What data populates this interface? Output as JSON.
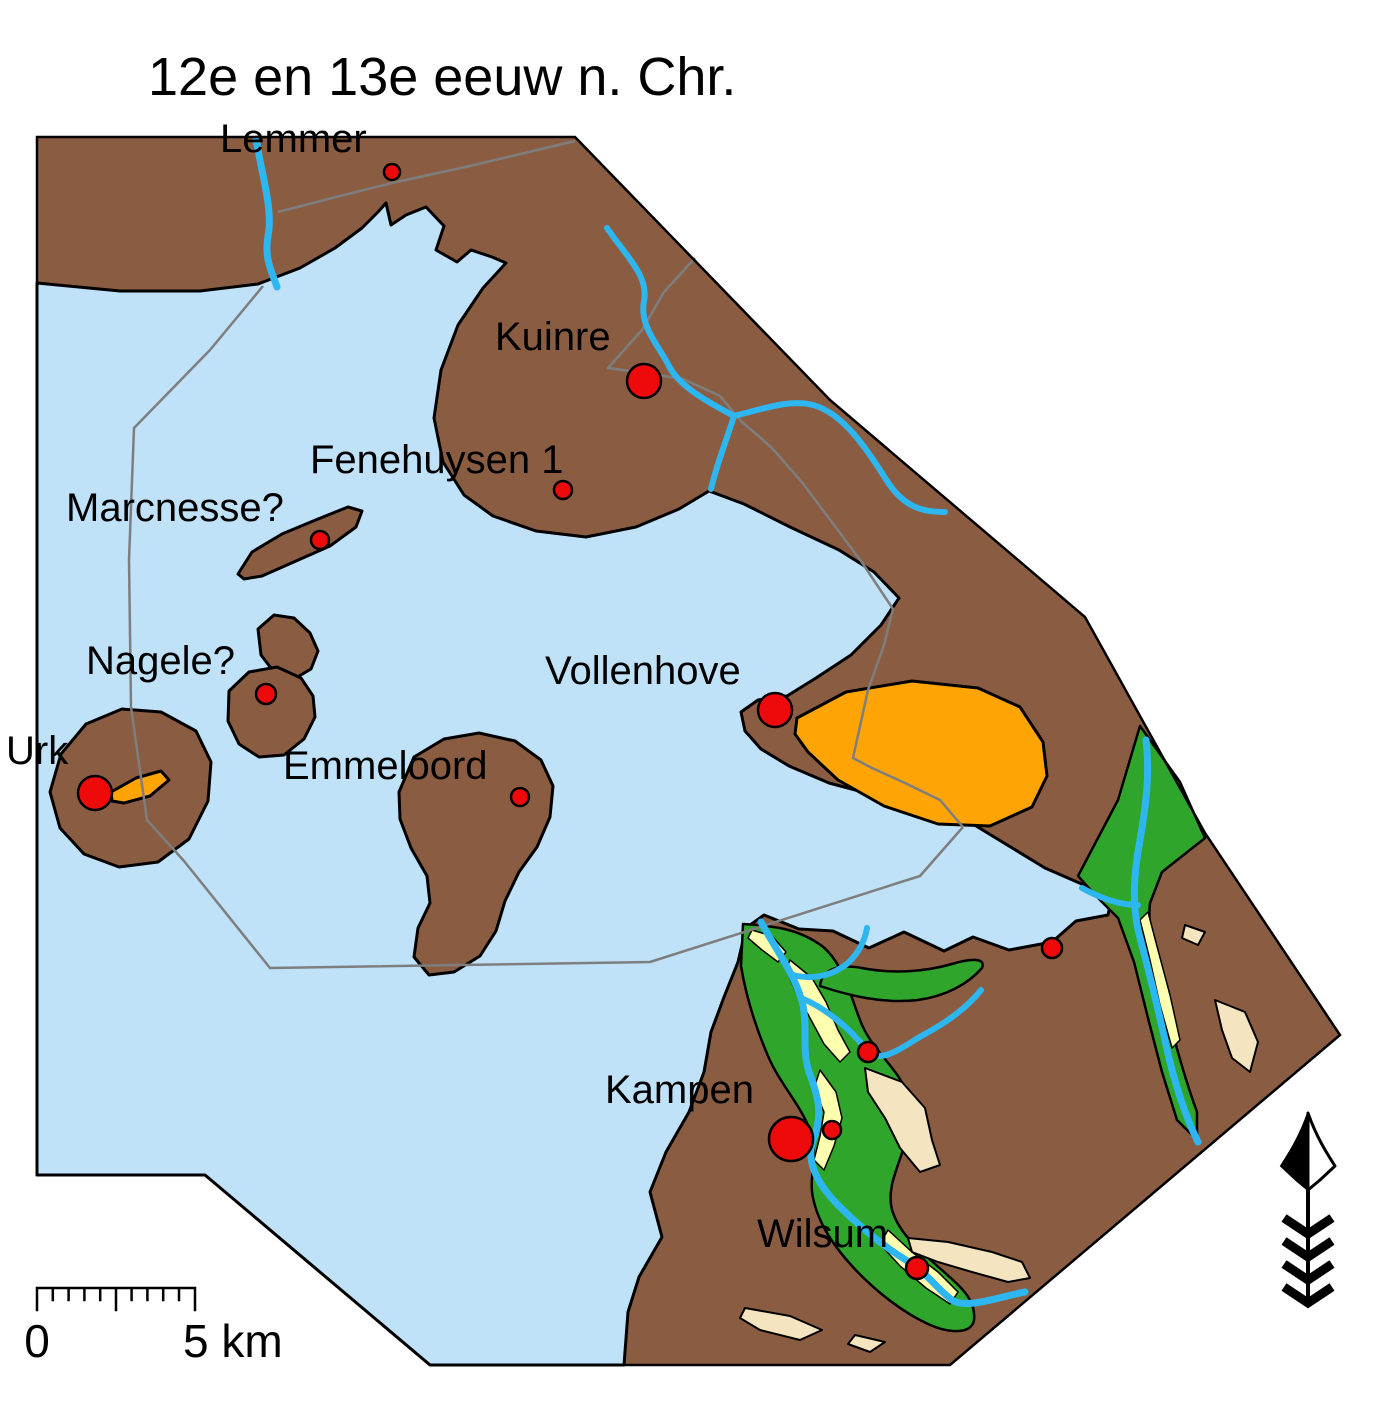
{
  "title": "12e en 13e eeuw n. Chr.",
  "colors": {
    "water": "#BFE2F8",
    "land": "#8A5C42",
    "sand_high": "#FFA405",
    "floodplain": "#2FA52B",
    "levee": "#FFFFB0",
    "river_dune": "#F4E4C0",
    "river": "#2EB6F0",
    "settlement_dot": "#EE0A0A",
    "boundary_gray": "#7E7E7E",
    "outline": "#000000",
    "background": "#FFFFFF"
  },
  "scale_bar": {
    "label_start": "0",
    "label_end": "5 km"
  },
  "north_arrow": "north-arrow",
  "settlements": [
    {
      "id": "lemmer",
      "name": "Lemmer",
      "dot": {
        "x": 392,
        "y": 172,
        "r": 8
      },
      "label": {
        "x": 220,
        "y": 152
      }
    },
    {
      "id": "kuinre",
      "name": "Kuinre",
      "dot": {
        "x": 644,
        "y": 381,
        "r": 17
      },
      "label": {
        "x": 495,
        "y": 350
      }
    },
    {
      "id": "fenehuysen-1",
      "name": "Fenehuysen 1",
      "dot": {
        "x": 563,
        "y": 490,
        "r": 9
      },
      "label": {
        "x": 310,
        "y": 473
      }
    },
    {
      "id": "marcnesse",
      "name": "Marcnesse?",
      "dot": {
        "x": 320,
        "y": 540,
        "r": 9
      },
      "label": {
        "x": 66,
        "y": 521
      }
    },
    {
      "id": "nagele",
      "name": "Nagele?",
      "dot": {
        "x": 266,
        "y": 694,
        "r": 10
      },
      "label": {
        "x": 86,
        "y": 674
      }
    },
    {
      "id": "urk",
      "name": "Urk",
      "dot": {
        "x": 95,
        "y": 793,
        "r": 17
      },
      "label": {
        "x": 6,
        "y": 764
      }
    },
    {
      "id": "emmeloord",
      "name": "Emmeloord",
      "dot": {
        "x": 520,
        "y": 797,
        "r": 9
      },
      "label": {
        "x": 283,
        "y": 779
      }
    },
    {
      "id": "vollenhove",
      "name": "Vollenhove",
      "dot": {
        "x": 775,
        "y": 710,
        "r": 17
      },
      "label": {
        "x": 545,
        "y": 684
      }
    },
    {
      "id": "kampen",
      "name": "Kampen",
      "dot": {
        "x": 791,
        "y": 1139,
        "r": 22
      },
      "label": {
        "x": 605,
        "y": 1103
      }
    },
    {
      "id": "wilsum",
      "name": "Wilsum",
      "dot": {
        "x": 917,
        "y": 1268,
        "r": 11
      },
      "label": {
        "x": 757,
        "y": 1247
      }
    },
    {
      "id": "site-zwartewater",
      "name": "",
      "dot": {
        "x": 1052,
        "y": 948,
        "r": 10
      }
    },
    {
      "id": "site-delta-east",
      "name": "",
      "dot": {
        "x": 868,
        "y": 1052,
        "r": 10
      }
    },
    {
      "id": "site-kampen-small",
      "name": "",
      "dot": {
        "x": 832,
        "y": 1130,
        "r": 9
      }
    }
  ]
}
